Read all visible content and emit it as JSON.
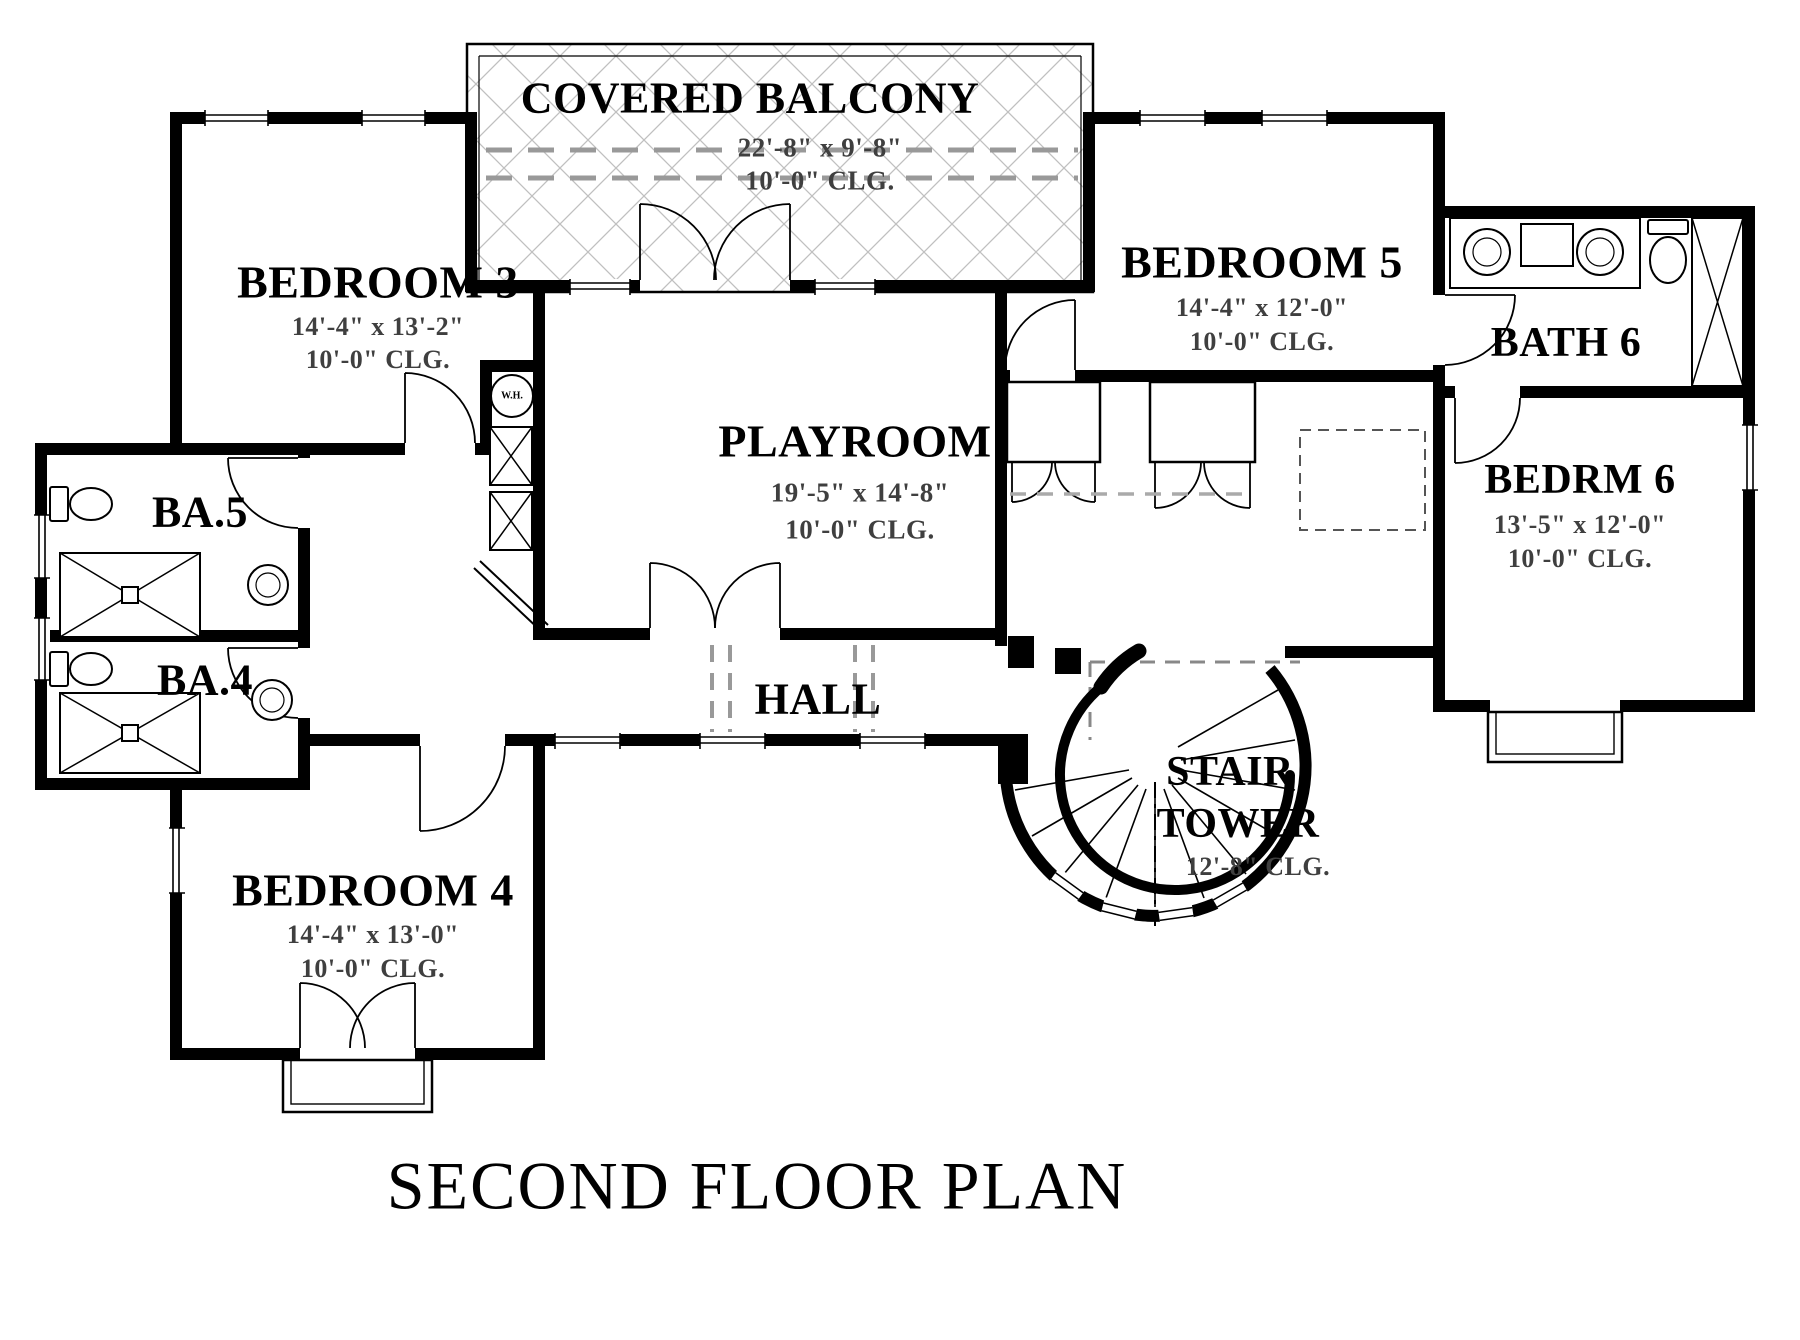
{
  "plan": {
    "title": "SECOND FLOOR PLAN",
    "rooms": {
      "covered_balcony": {
        "name": "COVERED BALCONY",
        "dims": "22'-8\" x 9'-8\"",
        "ceiling": "10'-0\" CLG."
      },
      "bedroom3": {
        "name": "BEDROOM 3",
        "dims": "14'-4\" x 13'-2\"",
        "ceiling": "10'-0\" CLG."
      },
      "bedroom5": {
        "name": "BEDROOM 5",
        "dims": "14'-4\" x 12'-0\"",
        "ceiling": "10'-0\" CLG."
      },
      "bath6": {
        "name": "BATH 6"
      },
      "bedrm6": {
        "name": "BEDRM 6",
        "dims": "13'-5\" x 12'-0\"",
        "ceiling": "10'-0\" CLG."
      },
      "ba5": {
        "name": "BA.5"
      },
      "ba4": {
        "name": "BA.4"
      },
      "playroom": {
        "name": "PLAYROOM",
        "dims": "19'-5\" x 14'-8\"",
        "ceiling": "10'-0\" CLG."
      },
      "hall": {
        "name": "HALL"
      },
      "stair_tower": {
        "name_line1": "STAIR",
        "name_line2": "TOWER",
        "ceiling": "12'-8\" CLG."
      },
      "bedroom4": {
        "name": "BEDROOM 4",
        "dims": "14'-4\" x 13'-0\"",
        "ceiling": "10'-0\" CLG."
      }
    },
    "fixtures": {
      "water_heater": "W.H."
    },
    "colors": {
      "walls": "#000000",
      "dimension_text": "#3f3f3f",
      "hatch_lines": "#c0c0c0",
      "dashed_lines": "#999999",
      "background": "#ffffff"
    }
  }
}
